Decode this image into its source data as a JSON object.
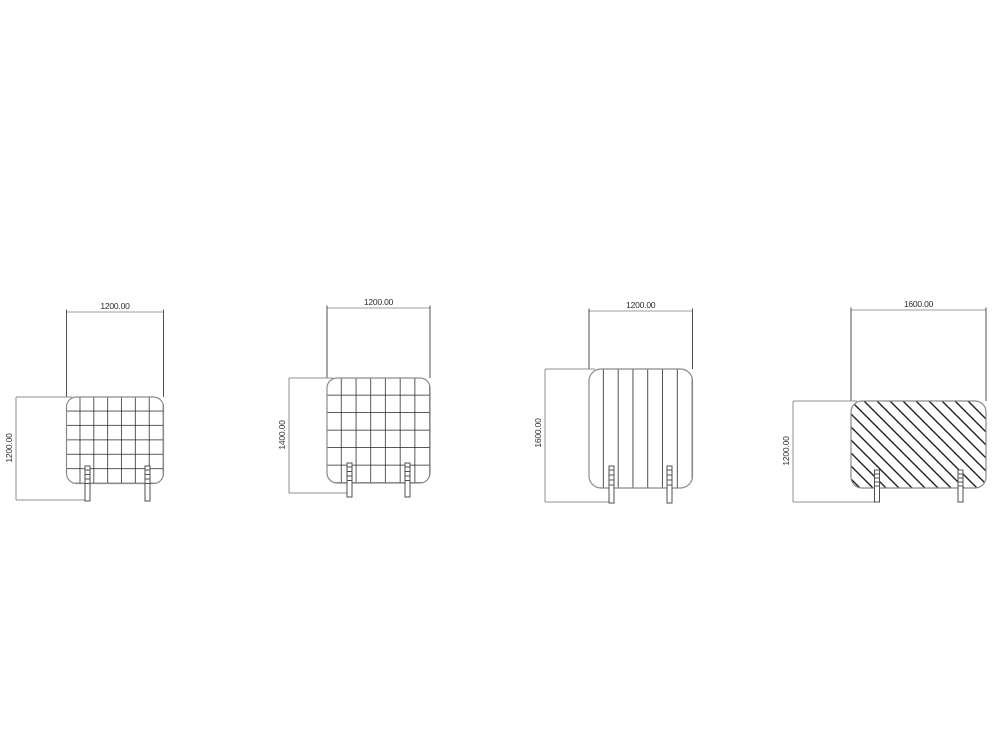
{
  "page": {
    "background_color": "#ffffff",
    "line_color_hatch": "#222222",
    "line_color_outline": "#8a8a8a",
    "line_color_dimension": "#9e9e9e",
    "text_color": "#2b2b2b"
  },
  "drawings": [
    {
      "name": "panel-fine-grid",
      "hatch": "fine-grid-mesh",
      "width_dim": "1200.00",
      "height_dim": "1200.00"
    },
    {
      "name": "panel-coarse-grid",
      "hatch": "coarse-grid-mesh",
      "width_dim": "1200.00",
      "height_dim": "1400.00"
    },
    {
      "name": "panel-vertical-slats",
      "hatch": "vertical-slats",
      "width_dim": "1200.00",
      "height_dim": "1600.00"
    },
    {
      "name": "panel-diagonal-hatch",
      "hatch": "diagonal-lines",
      "width_dim": "1600.00",
      "height_dim": "1200.00"
    }
  ]
}
